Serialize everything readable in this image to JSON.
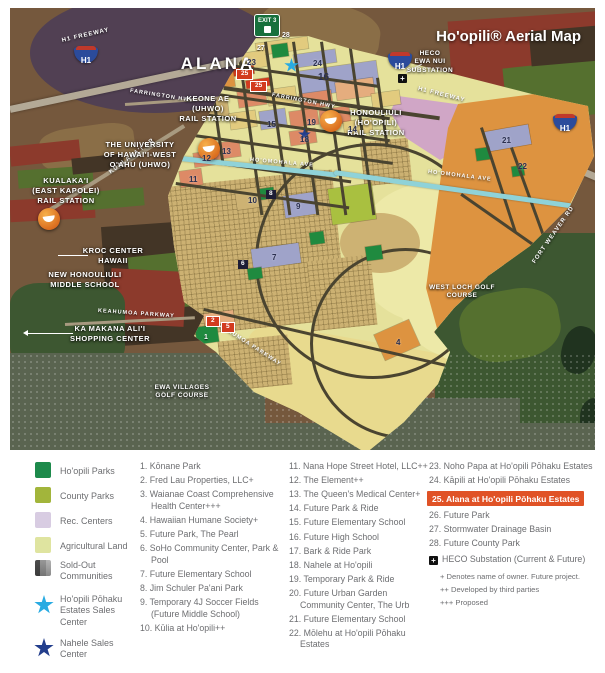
{
  "title": "Ho'opili® Aerial Map",
  "map": {
    "big_label": "ALANA",
    "exit_sign": "EXIT 3",
    "shield_label": "H1",
    "heco_plus": "+",
    "labels": {
      "keone_ae": "KEONE AE\n(UHWO)\nRAIL STATION",
      "university": "THE UNIVERSITY\nOF HAWAI'I-WEST\nO'AHU (UHWO)",
      "kualakai": "KUALAKA'I\n(EAST KAPOLEI)\nRAIL STATION",
      "honouliuli": "HONOULIULI\n(HO'OPILI)\nRAIL STATION",
      "heco": "HECO\nEWA NUI\nSUBSTATION",
      "kroc": "KROC CENTER\nHAWAII",
      "middle_school": "NEW HONOULIULI\nMIDDLE SCHOOL",
      "ka_makana": "KA MAKANA ALI'I\nSHOPPING CENTER",
      "west_loch": "WEST LOCH GOLF\nCOURSE",
      "ewa_villages": "EWA VILLAGES\nGOLF COURSE"
    },
    "roads": [
      "H1 FREEWAY",
      "H1 FREEWAY",
      "FARRINGTON HWY",
      "FARRINGTON HWY",
      "KUALAKA'I DR",
      "KEAHUMOA PARKWAY",
      "KEAHUMOA PARKWAY",
      "HO'OMOHALA AVE",
      "HO'OMOHALA AVE",
      "FORT WEAVER RD"
    ],
    "badges": [
      "28",
      "27",
      "23",
      "24",
      "16",
      "25",
      "25",
      "15",
      "19",
      "18",
      "14",
      "13",
      "12",
      "11",
      "10",
      "8",
      "9",
      "7",
      "6",
      "2",
      "5",
      "1",
      "4",
      "21",
      "22"
    ],
    "palette": {
      "devBase": "#e5e19b",
      "devLight": "#ede9a8",
      "parcelTan": "#cdb273",
      "salmon": "#dd8a66",
      "peach": "#e5ad7e",
      "yellow": "#e2cb7e",
      "yellow2": "#e8da8e",
      "lavender": "#9fa3c9",
      "green": "#1f8a3f",
      "olive": "#a9c040",
      "brightGreen": "#a8c83e",
      "orange": "#dd9340",
      "pink": "#d0a6c6",
      "red": "#d23b1f",
      "teal": "#8fd2d8",
      "road": "#4a4430",
      "freeway": "#b3a996",
      "mount": "#514053",
      "fieldRed": "#8c3a2c",
      "fieldGreen": "#55702f",
      "fieldDark": "#433526",
      "fieldTan": "#8a6e47",
      "suburb": "#5a6450",
      "forest": "#3d5731",
      "lake": "#20331f"
    }
  },
  "legend": {
    "swatches": [
      {
        "label": "Ho'opili Parks",
        "color": "#1d8a4b"
      },
      {
        "label": "County Parks",
        "color": "#a2b53b"
      },
      {
        "label": "Rec. Centers",
        "color": "#d8cce2"
      },
      {
        "label": "Agricultural Land",
        "color": "#dfe4a0"
      },
      {
        "label": "Sold-Out Communities",
        "color": "#9a9a9a"
      },
      {
        "label": "Ho'opili Pōhaku Estates Sales Center",
        "color": "#29abe2"
      },
      {
        "label": "Nahele Sales Center",
        "color": "#233e8c"
      }
    ],
    "col1": [
      "1. Kōnane Park",
      "2. Fred Lau Properties, LLC+",
      "3. Waianae Coast Comprehensive Health Center+++",
      "4. Hawaiian Humane Society+",
      "5. Future Park, The Pearl",
      "6. SoHo Community Center, Park & Pool",
      "7. Future Elementary School",
      "8. Jim Schuler Pa'ani Park",
      "9. Temporary 4J Soccer Fields (Future Middle School)",
      "10. Kūlia at Ho'opili++"
    ],
    "col2": [
      "11. Nana Hope Street Hotel, LLC++",
      "12. The Element++",
      "13. The Queen's Medical Center+",
      "14. Future Park & Ride",
      "15. Future Elementary School",
      "16. Future High School",
      "17. Bark & Ride Park",
      "18. Nahele at Ho'opili",
      "19. Temporary Park & Ride",
      "20. Future Urban Garden Community Center, The Urb",
      "21. Future Elementary School",
      "22. Mōlehu at Ho'opili Pōhaku Estates"
    ],
    "col3_before": [
      "23. Noho Papa at Ho'opili Pōhaku Estates",
      "24. Kāpili at Ho'opili Pōhaku Estates"
    ],
    "col3_highlight": "25. Alana at Ho'opili Pōhaku Estates",
    "highlight_color": "#e05226",
    "col3_after": [
      "26. Future Park",
      "27. Stormwater Drainage Basin",
      "28. Future County Park"
    ],
    "heco_label": "HECO Substation (Current & Future)",
    "heco_plus": "+",
    "footnotes": [
      "+ Denotes name of owner. Future project.",
      "++ Developed by third parties",
      "+++ Proposed"
    ]
  }
}
